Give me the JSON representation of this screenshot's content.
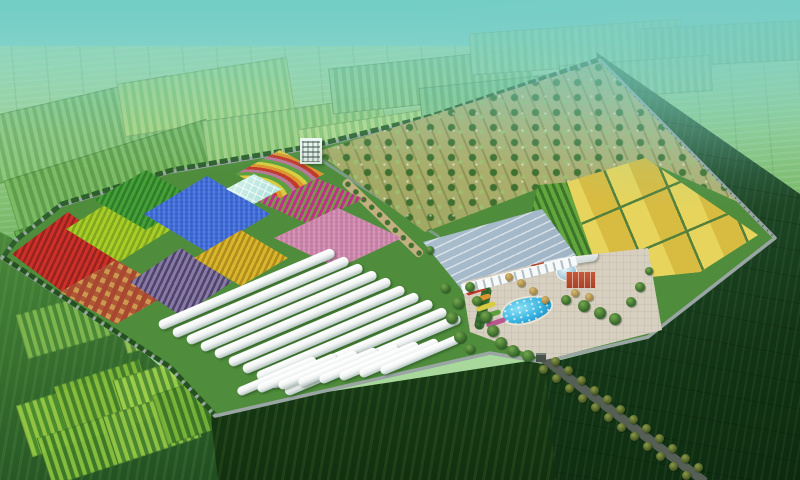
{
  "scene": {
    "title": "Aerial rendering of a walled agricultural demonstration park",
    "style": "3D bird's-eye architectural visualization, hazy teal sky over green farmland",
    "features": {
      "orchard_rows": "tree orchard filling the north-east half of the park",
      "crop_plot_count": 9,
      "greenhouse_tunnels_back_row": 10,
      "greenhouse_tunnels_front_row": 8,
      "grain_field_patches": 8,
      "central_facilities": [
        "large glass exhibition greenhouse",
        "curved office building with glass dome",
        "two red brick buildings",
        "paved plaza",
        "blue pool with fountains",
        "rainbow flower garden",
        "small white office tower"
      ],
      "access_road": "tree-lined road leaving the south-east gate"
    }
  },
  "palette": {
    "sky-top": "#6ecac4",
    "sky-mid": "#8fd6ca",
    "horizon": "#bfe4c2",
    "ground": "#4f8c3c",
    "wall": "#9aa6a4",
    "wall-dark": "#5f6f68",
    "hedge": "#2d5f2b",
    "hedge2": "#24511f",
    "orchard-tan": "#c4b98c",
    "orchard-olive": "#7e9448",
    "tree-dark": "#3f7030",
    "tree-mid": "#4e8238",
    "tree-light": "#9cc070",
    "tunnel-sh": "#b5c4c2",
    "roof-light": "#ccdce6",
    "roof-dark": "#8aa2b6",
    "arcade": "#f6f9f9",
    "crops-light": "#63a63e",
    "crops-dark": "#3c7529",
    "gold1": "#d8bc42",
    "gold2": "#e6d45c",
    "gold-grid": "#54803c",
    "plaza": "#d7cfc0",
    "pool-hi": "#8ce0f4",
    "pool-mid": "#35b2e0",
    "pool-dark": "#1478b4",
    "brick": "#b8452e",
    "brick-dark": "#a84228",
    "dome-glass": "#9fc8d8",
    "road": "#555f56",
    "road-tree": "#41511e",
    "garden-base": "#b8a868",
    "glasshouse": "#a8ded6",
    "tan-path": "#c2b080",
    "pond": "#3c6a84",
    "white-bldg": "#d8e2da",
    "path": "#7e9b88"
  },
  "background": {
    "far_patches": [
      {
        "x": -15,
        "y": 96,
        "w": 190,
        "h": 66,
        "rot": -13,
        "c1": "#8fc77e",
        "c2": "#6fae5e"
      },
      {
        "x": 120,
        "y": 70,
        "w": 170,
        "h": 52,
        "rot": -9,
        "c1": "#b2d884",
        "c2": "#8cc46c"
      },
      {
        "x": 10,
        "y": 148,
        "w": 210,
        "h": 74,
        "rot": -17,
        "c1": "#7cbb63",
        "c2": "#5c9c4a"
      },
      {
        "x": 205,
        "y": 108,
        "w": 180,
        "h": 56,
        "rot": -8,
        "c1": "#a5d287",
        "c2": "#7fbc66"
      },
      {
        "x": 330,
        "y": 58,
        "w": 200,
        "h": 44,
        "rot": -6,
        "c1": "#9ccf92",
        "c2": "#78b670"
      },
      {
        "x": 470,
        "y": 26,
        "w": 210,
        "h": 40,
        "rot": -4,
        "c1": "#a6d6a0",
        "c2": "#88c286"
      },
      {
        "x": 640,
        "y": 24,
        "w": 170,
        "h": 38,
        "rot": -3,
        "c1": "#97cc97",
        "c2": "#7ab67f"
      },
      {
        "x": 20,
        "y": 205,
        "w": 150,
        "h": 62,
        "rot": -19,
        "c1": "#6cae50",
        "c2": "#4c8e3e"
      },
      {
        "x": 160,
        "y": 170,
        "w": 140,
        "h": 52,
        "rot": -14,
        "c1": "#8cc470",
        "c2": "#68a854"
      },
      {
        "x": 300,
        "y": 118,
        "w": 140,
        "h": 40,
        "rot": -9,
        "c1": "#b8dc8c",
        "c2": "#90c474"
      },
      {
        "x": 420,
        "y": 80,
        "w": 150,
        "h": 36,
        "rot": -6,
        "c1": "#8cc88c",
        "c2": "#70b274"
      },
      {
        "x": 560,
        "y": 60,
        "w": 150,
        "h": 34,
        "rot": -4,
        "c1": "#a0d29c",
        "c2": "#84be84"
      }
    ],
    "left_patches": [
      {
        "x": 22,
        "y": 390,
        "w": 92,
        "h": 52,
        "rot": -18,
        "c1": "#9acc44",
        "c2": "#4e8f30"
      },
      {
        "x": 58,
        "y": 372,
        "w": 88,
        "h": 44,
        "rot": -18,
        "c1": "#88bc3c",
        "c2": "#44802a"
      },
      {
        "x": 118,
        "y": 366,
        "w": 86,
        "h": 46,
        "rot": -18,
        "c1": "#a2d24c",
        "c2": "#528f34"
      },
      {
        "x": 42,
        "y": 422,
        "w": 96,
        "h": 48,
        "rot": -18,
        "c1": "#8cc440",
        "c2": "#3f7a28"
      },
      {
        "x": 108,
        "y": 402,
        "w": 86,
        "h": 48,
        "rot": -18,
        "c1": "#96c846",
        "c2": "#488430"
      },
      {
        "x": 158,
        "y": 382,
        "w": 76,
        "h": 50,
        "rot": -18,
        "c1": "#7ab438",
        "c2": "#3a7426"
      },
      {
        "x": 20,
        "y": 300,
        "w": 100,
        "h": 44,
        "rot": -16,
        "c1": "#84ba50",
        "c2": "#4c8a38"
      },
      {
        "x": 120,
        "y": 300,
        "w": 90,
        "h": 40,
        "rot": -16,
        "c1": "#98c858",
        "c2": "#568e38"
      }
    ]
  },
  "complex": {
    "plots": [
      {
        "name": "crop-plot-red",
        "pattern": "rows",
        "c1": "#cc3028",
        "c2": "#96231e",
        "x": 12,
        "y": 212,
        "w": 112,
        "h": 84
      },
      {
        "name": "crop-plot-lime",
        "pattern": "rows",
        "c1": "#aacc28",
        "c2": "#7fa81e",
        "x": 66,
        "y": 196,
        "w": 106,
        "h": 66
      },
      {
        "name": "crop-plot-green",
        "pattern": "rows",
        "c1": "#46a038",
        "c2": "#2f7d28",
        "x": 94,
        "y": 170,
        "w": 104,
        "h": 60
      },
      {
        "name": "crop-plot-blue",
        "pattern": "dots",
        "c1": "#5580e4",
        "c2": "#3b63cc",
        "x": 144,
        "y": 176,
        "w": 126,
        "h": 76
      },
      {
        "name": "crop-plot-orange-checker",
        "pattern": "checker",
        "c1": "#cc9850",
        "c2": "#a84830",
        "x": 60,
        "y": 260,
        "w": 112,
        "h": 64
      },
      {
        "name": "crop-plot-purple",
        "pattern": "rows",
        "c1": "#8878a8",
        "c2": "#4e4468",
        "x": 130,
        "y": 248,
        "w": 102,
        "h": 68
      },
      {
        "name": "crop-plot-gold",
        "pattern": "rows",
        "c1": "#d8b62e",
        "c2": "#b08c1c",
        "x": 194,
        "y": 230,
        "w": 94,
        "h": 56
      },
      {
        "name": "crop-plot-magenta",
        "pattern": "rows",
        "c1": "#c0308a",
        "c2": "#7a9a4a",
        "x": 252,
        "y": 174,
        "w": 112,
        "h": 50
      },
      {
        "name": "crop-plot-pink",
        "pattern": "dots",
        "c1": "#d898b8",
        "c2": "#c47ea4",
        "x": 274,
        "y": 208,
        "w": 128,
        "h": 60
      }
    ],
    "tunnel_bands": [
      {
        "name": "greenhouse-band-back",
        "count": 10,
        "x": 334,
        "y": 252,
        "dx": 14,
        "dy": 7.3,
        "len": 190,
        "w": 9.5,
        "angle": -23
      },
      {
        "name": "greenhouse-band-front",
        "count": 8,
        "x": 316,
        "y": 359,
        "dx": 20.4,
        "dy": -2.9,
        "len": 85,
        "w": 9,
        "angle": -23
      }
    ]
  },
  "deco": {
    "trees": [
      [
        470,
        287,
        5
      ],
      [
        477,
        301,
        5
      ],
      [
        486,
        317,
        6
      ],
      [
        493,
        331,
        6
      ],
      [
        501,
        343,
        6
      ],
      [
        513,
        351,
        6
      ],
      [
        528,
        356,
        6
      ],
      [
        566,
        300,
        5
      ],
      [
        584,
        306,
        6
      ],
      [
        600,
        313,
        6
      ],
      [
        615,
        319,
        6
      ],
      [
        631,
        302,
        5
      ],
      [
        640,
        287,
        5
      ],
      [
        649,
        271,
        4
      ],
      [
        458,
        303,
        6
      ],
      [
        452,
        318,
        6
      ],
      [
        460,
        337,
        6
      ],
      [
        470,
        349,
        5
      ],
      [
        445,
        288,
        5
      ],
      [
        430,
        250,
        4
      ]
    ],
    "cones": [
      [
        509,
        277,
        4
      ],
      [
        521,
        283,
        4
      ],
      [
        533,
        291,
        4
      ],
      [
        575,
        293,
        4
      ],
      [
        589,
        297,
        4
      ],
      [
        545,
        300,
        4
      ]
    ],
    "road_trees": {
      "count": 12,
      "x": 549,
      "y": 365,
      "dx": 13,
      "dy": 9.7,
      "spreadx": 6,
      "spready": 4
    }
  }
}
